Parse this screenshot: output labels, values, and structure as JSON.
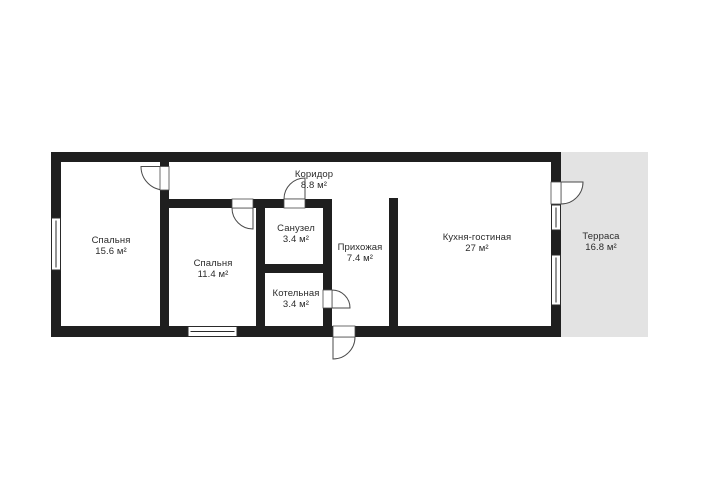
{
  "floor_plan": {
    "colors": {
      "wall": "#1f1f1f",
      "terrace_fill": "#e3e3e3",
      "background": "#ffffff",
      "label_text": "#2b2b2b"
    },
    "rooms": [
      {
        "id": "bedroom-1",
        "name": "Спальня",
        "area": "15.6 м²"
      },
      {
        "id": "bedroom-2",
        "name": "Спальня",
        "area": "11.4 м²"
      },
      {
        "id": "bathroom",
        "name": "Санузел",
        "area": "3.4 м²"
      },
      {
        "id": "boiler-room",
        "name": "Котельная",
        "area": "3.4 м²"
      },
      {
        "id": "hallway",
        "name": "Прихожая",
        "area": "7.4 м²"
      },
      {
        "id": "corridor",
        "name": "Коридор",
        "area": "8.8 м²"
      },
      {
        "id": "kitchen-living-room",
        "name": "Кухня-гостиная",
        "area": "27 м²"
      },
      {
        "id": "terrace",
        "name": "Терраса",
        "area": "16.8 м²"
      }
    ]
  }
}
